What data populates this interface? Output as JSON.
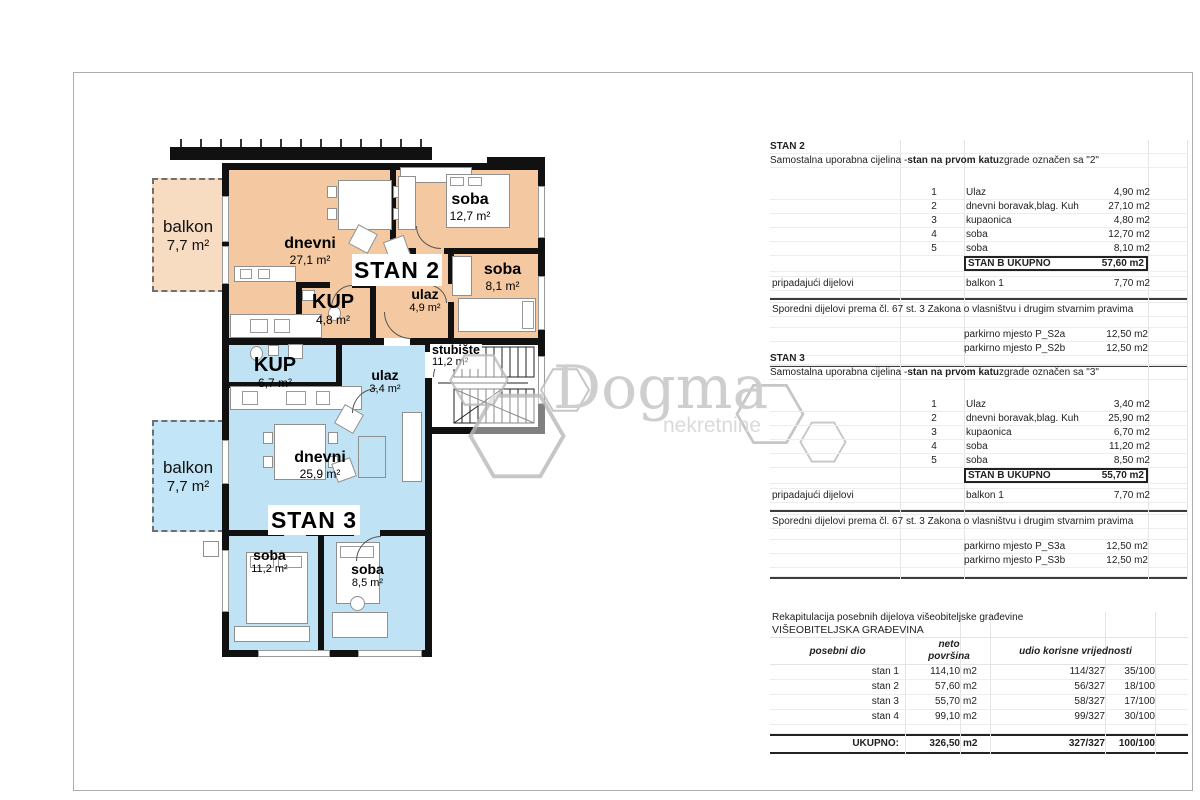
{
  "colors": {
    "stan2_fill": "#f4c9a1",
    "stan2_balkon": "#f8dcc2",
    "stan3_fill": "#bfe3f5",
    "stan3_balkon": "#c2e6f7",
    "wall": "#111111",
    "watermark": "#c6c6c6"
  },
  "plan": {
    "stan2": {
      "label": "STAN 2",
      "balkon": {
        "name": "balkon",
        "area": "7,7 m²"
      },
      "dnevni": {
        "name": "dnevni",
        "area": "27,1 m²"
      },
      "soba_big": {
        "name": "soba",
        "area": "12,7 m²"
      },
      "soba_small": {
        "name": "soba",
        "area": "8,1 m²"
      },
      "kup": {
        "name": "KUP",
        "area": "4,8 m²"
      },
      "ulaz": {
        "name": "ulaz",
        "area": "4,9 m²"
      }
    },
    "stan3": {
      "label": "STAN 3",
      "balkon": {
        "name": "balkon",
        "area": "7,7 m²"
      },
      "kup": {
        "name": "KUP",
        "area": "6,7 m²"
      },
      "ulaz": {
        "name": "ulaz",
        "area": "3,4 m²"
      },
      "dnevni": {
        "name": "dnevni",
        "area": "25,9 m²"
      },
      "soba_big": {
        "name": "soba",
        "area": "11,2 m²"
      },
      "soba_small": {
        "name": "soba",
        "area": "8,5 m²"
      }
    },
    "stubiste": {
      "name": "stubište",
      "area": "11,2 m²"
    },
    "watermark": {
      "brand": "Dogma",
      "tagline": "nekretnine"
    }
  },
  "tables": {
    "stan2": {
      "title": "STAN 2",
      "subtitle_prefix": "Samostalna uporabna cijelina - ",
      "subtitle_bold": "stan na prvom katu",
      "subtitle_suffix": " zgrade označen sa \"2\"",
      "rows": [
        {
          "num": "1",
          "name": "Ulaz",
          "area": "4,90 m2"
        },
        {
          "num": "2",
          "name": "dnevni boravak,blag. Kuh",
          "area": "27,10 m2"
        },
        {
          "num": "3",
          "name": "kupaonica",
          "area": "4,80 m2"
        },
        {
          "num": "4",
          "name": "soba",
          "area": "12,70 m2"
        },
        {
          "num": "5",
          "name": "soba",
          "area": "8,10 m2"
        }
      ],
      "total_label": "STAN B UKUPNO",
      "total_area": "57,60 m2",
      "pripadajuci_label": "pripadajući dijelovi",
      "pripadajuci_name": "balkon 1",
      "pripadajuci_area": "7,70 m2",
      "sporedni_text": "Sporedni dijelovi prema čl. 67 st. 3 Zakona o vlasništvu i drugim stvarnim pravima",
      "parking": [
        {
          "name": "parkirno mjesto P_S2a",
          "area": "12,50 m2"
        },
        {
          "name": "parkirno mjesto  P_S2b",
          "area": "12,50 m2"
        }
      ]
    },
    "stan3": {
      "title": "STAN 3",
      "subtitle_prefix": "Samostalna uporabna cijelina - ",
      "subtitle_bold": "stan na prvom katu",
      "subtitle_suffix": " zgrade označen sa \"3\"",
      "rows": [
        {
          "num": "1",
          "name": "Ulaz",
          "area": "3,40 m2"
        },
        {
          "num": "2",
          "name": "dnevni boravak,blag. Kuh",
          "area": "25,90 m2"
        },
        {
          "num": "3",
          "name": "kupaonica",
          "area": "6,70 m2"
        },
        {
          "num": "4",
          "name": "soba",
          "area": "11,20 m2"
        },
        {
          "num": "5",
          "name": "soba",
          "area": "8,50 m2"
        }
      ],
      "total_label": "STAN B UKUPNO",
      "total_area": "55,70 m2",
      "pripadajuci_label": "pripadajući dijelovi",
      "pripadajuci_name": "balkon 1",
      "pripadajuci_area": "7,70 m2",
      "sporedni_text": "Sporedni dijelovi prema čl. 67 st. 3 Zakona o vlasništvu i drugim stvarnim pravima",
      "parking": [
        {
          "name": "parkirno mjesto P_S3a",
          "area": "12,50 m2"
        },
        {
          "name": "parkirno mjesto  P_S3b",
          "area": "12,50 m2"
        }
      ]
    },
    "recap": {
      "title": "Rekapitulacija posebnih dijelova višeobiteljske građevine",
      "subtitle": "VIŠEOBITELJSKA GRAĐEVINA",
      "col_posebni": "posebni dio",
      "col_neto_1": "neto",
      "col_neto_2": "površina",
      "col_udio": "udio korisne vrijednosti",
      "rows": [
        {
          "name": "stan 1",
          "area": "114,10",
          "unit": "m2",
          "share": "114/327",
          "pct": "35/100"
        },
        {
          "name": "stan 2",
          "area": "57,60",
          "unit": "m2",
          "share": "56/327",
          "pct": "18/100"
        },
        {
          "name": "stan 3",
          "area": "55,70",
          "unit": "m2",
          "share": "58/327",
          "pct": "17/100"
        },
        {
          "name": "stan 4",
          "area": "99,10",
          "unit": "m2",
          "share": "99/327",
          "pct": "30/100"
        }
      ],
      "total_label": "UKUPNO:",
      "total_area": "326,50",
      "total_unit": "m2",
      "total_share": "327/327",
      "total_pct": "100/100"
    }
  }
}
